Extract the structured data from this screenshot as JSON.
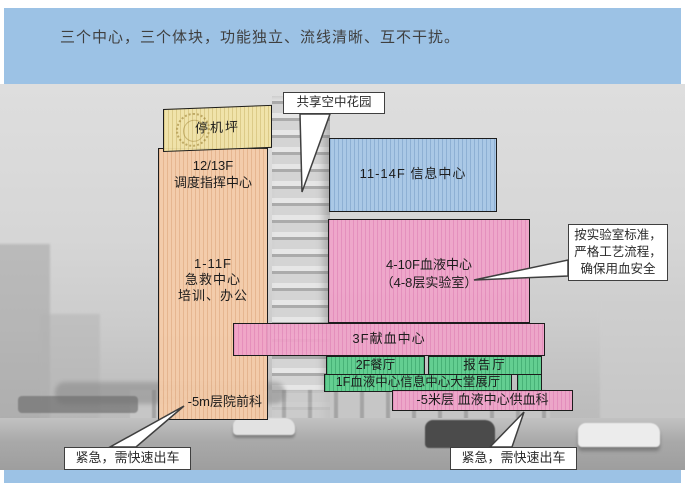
{
  "slide": {
    "title": "三个中心，三个体块，功能独立、流线清晰、互不干扰。"
  },
  "colors": {
    "band_blue": "#9cc2e5",
    "block_yellow": "#f0e3a6",
    "block_tan": "#f4cba9",
    "block_blue": "#a6c6e6",
    "block_pink": "#efa4c9",
    "block_green": "#5ecf8e",
    "callout_border": "#3f3f3f"
  },
  "blocks": {
    "helipad": {
      "label": "停机坪"
    },
    "dispatch": {
      "line1": "12/13F",
      "line2": "调度指挥中心"
    },
    "emergency": {
      "line1": "1-11F",
      "line2": "急救中心",
      "line3": "培训、办公",
      "basement": "-5m层院前科"
    },
    "info": {
      "label": "11-14F 信息中心"
    },
    "blood": {
      "line1": "4-10F血液中心",
      "line2": "（4-8层实验室）"
    },
    "donation": {
      "label": "3F献血中心"
    },
    "restaurant": {
      "label": "2F餐厅"
    },
    "lecture_hall": {
      "label": "报告厅"
    },
    "lobby": {
      "label": "1F血液中心信息中心大堂展厅"
    },
    "blood_supply": {
      "label": "-5米层 血液中心供血科"
    }
  },
  "callouts": {
    "sky_garden": {
      "label": "共享空中花园"
    },
    "lab_standard": {
      "line1": "按实验室标准，",
      "line2": "严格工艺流程，",
      "line3": "确保用血安全"
    },
    "urgent_left": {
      "label": "紧急，需快速出车"
    },
    "urgent_right": {
      "label": "紧急，需快速出车"
    }
  }
}
